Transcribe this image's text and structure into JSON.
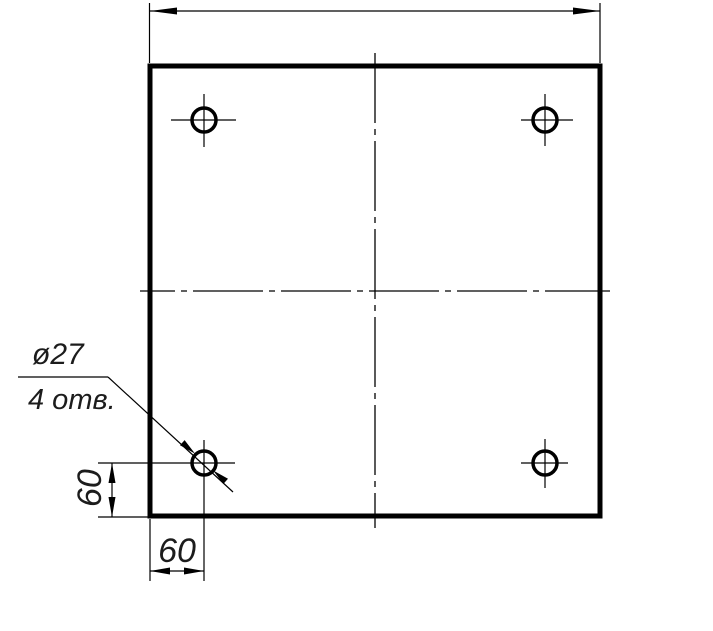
{
  "drawing": {
    "background_color": "#ffffff",
    "line_color": "#000000",
    "text_color": "#1c1c1c",
    "callout": {
      "diameter_label": "ø27",
      "count_label": "4 отв."
    },
    "dimensions": {
      "hole_offset_horizontal": "60",
      "hole_offset_vertical": "60"
    }
  }
}
